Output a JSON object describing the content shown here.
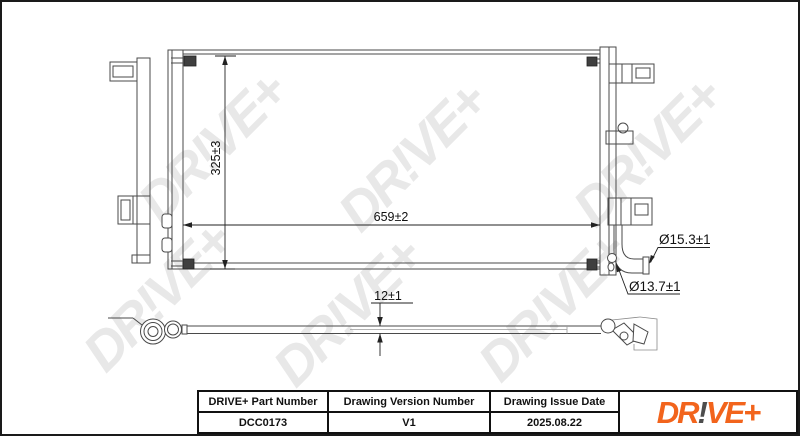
{
  "watermark_text": "DR!VE+",
  "front_view": {
    "dim_height": "325±3",
    "dim_width": "659±2"
  },
  "side_view": {
    "dim_thickness": "12±1"
  },
  "callouts": {
    "pipe_large": "Ø15.3±1",
    "pipe_small": "Ø13.7±1"
  },
  "title_block": {
    "part_number_header": "DRIVE+ Part Number",
    "part_number": "DCC0173",
    "version_header": "Drawing Version Number",
    "version": "V1",
    "date_header": "Drawing Issue Date",
    "date": "2025.08.22",
    "logo": {
      "pre": "DR",
      "bang": "!",
      "post": "VE+"
    }
  },
  "colors": {
    "logo_orange": "#F2641C",
    "logo_bang_gray": "#4D4D4D",
    "drawing_line": "#4A4A4A",
    "watermark_gray": "#E8E8E8",
    "frame_black": "#1A1A1A"
  }
}
